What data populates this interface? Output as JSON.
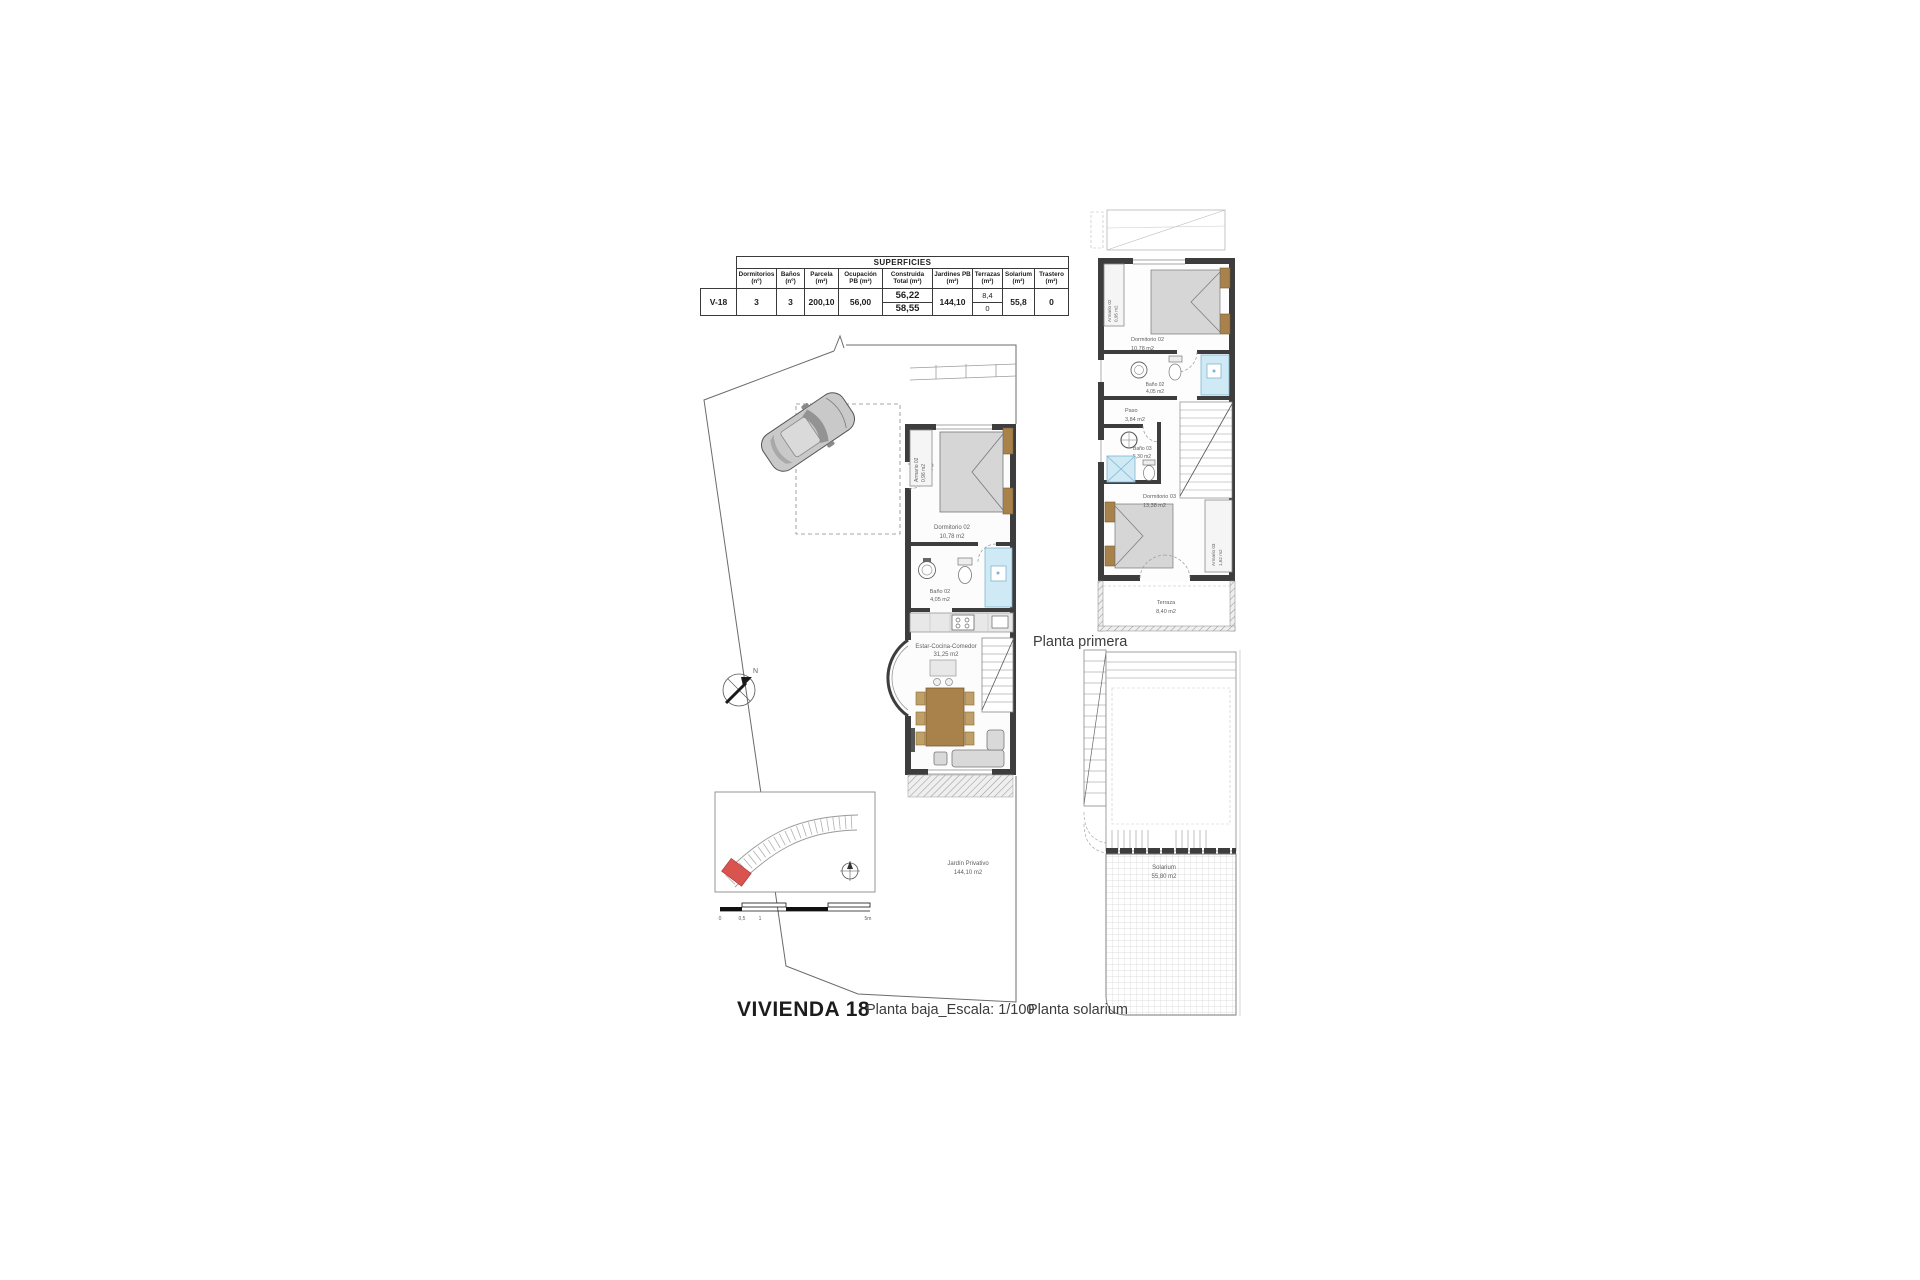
{
  "titles": {
    "vivienda": "VIVIENDA 18",
    "planta_baja": "Planta baja_Escala: 1/100",
    "planta_primera": "Planta primera",
    "planta_solarium": "Planta solarium"
  },
  "surfaces_table": {
    "title": "SUPERFICIES",
    "columns": [
      "Dormitorios (nº)",
      "Baños (nº)",
      "Parcela (m²)",
      "Ocupación PB (m²)",
      "Construida Total (m²)",
      "Jardines PB (m²)",
      "Terrazas (m²)",
      "Solarium (m²)",
      "Trastero (m²)"
    ],
    "row": {
      "id": "V-18",
      "dormitorios": "3",
      "banos": "3",
      "parcela": "200,10",
      "ocupacion_pb": "56,00",
      "construida_total_pb": "56,22",
      "construida_total_p1": "58,55",
      "jardines_pb": "144,10",
      "terrazas_a": "8,4",
      "terrazas_b": "0",
      "solarium": "55,8",
      "trastero": "0"
    }
  },
  "ground_floor": {
    "compass_label": "N",
    "rooms": {
      "armario": {
        "name": "Armario 02",
        "area": "0,96 m2"
      },
      "dormitorio": {
        "name": "Dormitorio 02",
        "area": "10,78 m2"
      },
      "bano": {
        "name": "Baño 02",
        "area": "4,05 m2"
      },
      "estar": {
        "name": "Estar-Cocina-Comedor",
        "area": "31,25 m2"
      },
      "jardin": {
        "name": "Jardín Privativo",
        "area": "144,10 m2"
      }
    },
    "scale_bar": {
      "labels": [
        "0",
        "0,5",
        "1",
        "5m"
      ]
    }
  },
  "first_floor": {
    "rooms": {
      "armario02": {
        "name": "Armario 02",
        "area": "0,95 m2"
      },
      "dormitorio02": {
        "name": "Dormitorio 02",
        "area": "10,78 m2"
      },
      "bano02": {
        "name": "Baño 02",
        "area": "4,05 m2"
      },
      "paso": {
        "name": "Paso",
        "area": "3,84 m2"
      },
      "bano03": {
        "name": "Baño 03",
        "area": "5,30 m2"
      },
      "dormitorio03": {
        "name": "Dormitorio 03",
        "area": "13,38 m2"
      },
      "armario03": {
        "name": "Armario 03",
        "area": "1,62 m2"
      },
      "terraza": {
        "name": "Terraza",
        "area": "8,40 m2"
      }
    }
  },
  "solarium_floor": {
    "rooms": {
      "solarium": {
        "name": "Solarium",
        "area": "55,80 m2"
      }
    }
  },
  "colors": {
    "wall": "#3d3d3d",
    "wood": "#a8824a",
    "wood_light": "#bfa068",
    "shower": "#cfe9f5",
    "highlight": "#d9534f"
  }
}
